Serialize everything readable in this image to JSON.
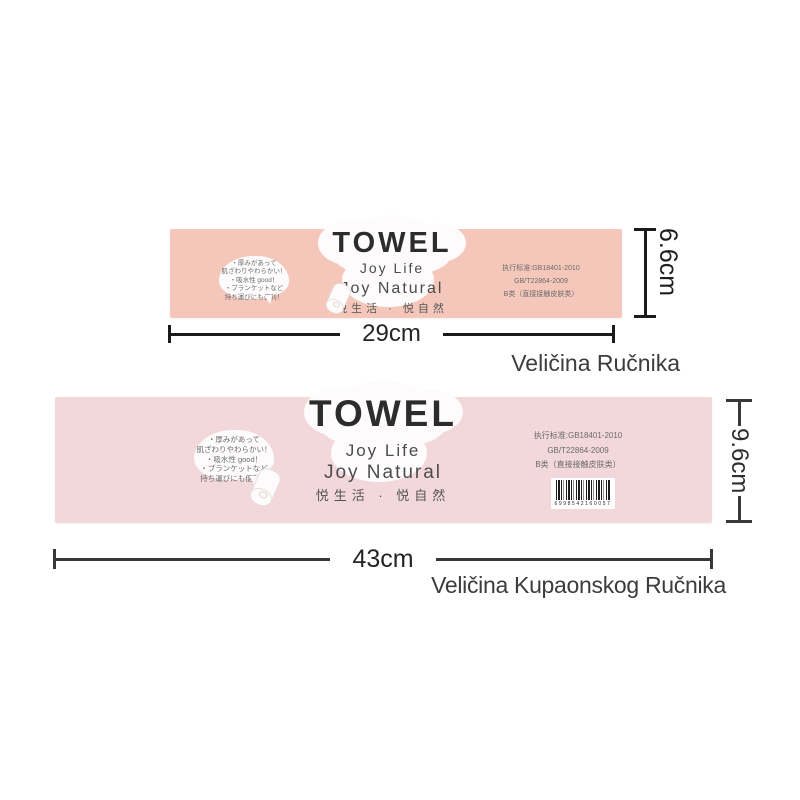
{
  "brand": {
    "title": "TOWEL",
    "tagline1": "Joy Life",
    "tagline2": "Joy Natural",
    "tagline_cn": "悦生活 · 悦自然"
  },
  "bubble": {
    "line1": "・厚みがあって",
    "line2": "肌ざわりやわらかい！",
    "line3": "・吸水性 good！",
    "line4": "・ブランケットなど",
    "line5": "持ち運びにも便利！"
  },
  "standards": {
    "line1": "执行标准:GB18401-2010",
    "line2": "GB/T22864-2009",
    "line3": "B类（直接接触皮肤类）"
  },
  "hand_towel": {
    "width": "29cm",
    "height": "6.6cm",
    "caption": "Veličina Ručnika",
    "label_color": "#f5c7ba"
  },
  "bath_towel": {
    "width": "43cm",
    "height": "9.6cm",
    "caption": "Veličina Kupaonskog Ručnika",
    "label_color": "#f2d7db",
    "barcode_digits": "6998542160057"
  },
  "colors": {
    "background": "#ffffff",
    "cloud": "#fdfbfb",
    "dimension_line_dark": "#1b1b1b",
    "dimension_line_gray": "#383838",
    "title_text": "#2d2c2c"
  }
}
